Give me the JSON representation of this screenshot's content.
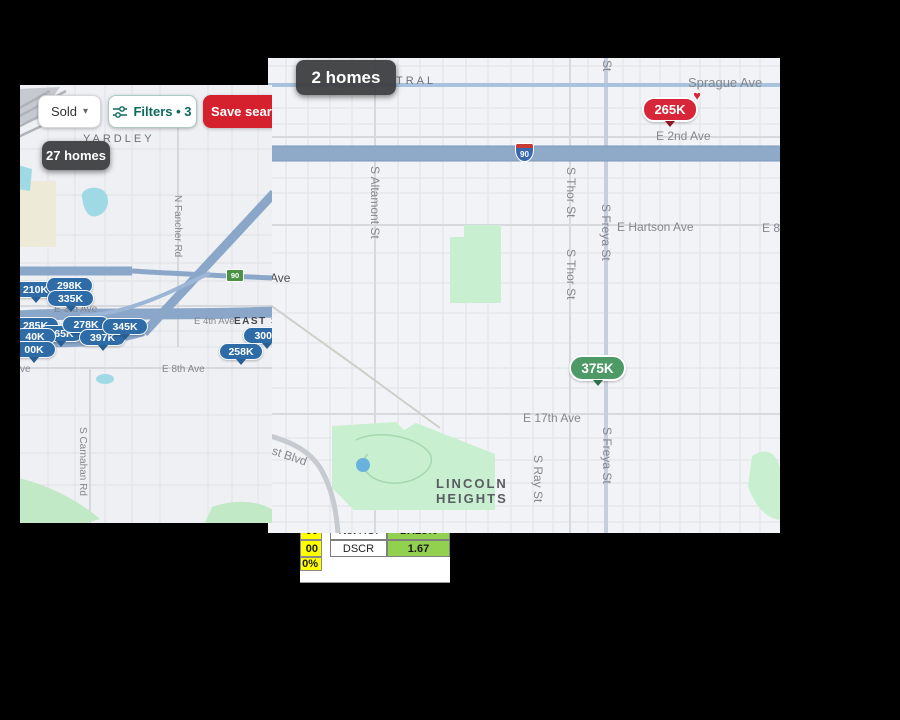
{
  "window_small_map": {
    "toolbar": {
      "sold": "Sold",
      "filters": "Filters • 3",
      "save_search": "Save search"
    },
    "badge": "27 homes",
    "shield": "90",
    "area_labels": {
      "yardley": "YARDLEY",
      "east_s": "EAST S"
    },
    "street_labels": {
      "e3rd": "E 3rd Ave",
      "e4th": "E 4th Ave",
      "e8th": "E 8th Ave",
      "ave_clipped": "ve",
      "fancher": "N Fancher Rd",
      "carnahan": "S Carnahan Rd"
    },
    "pins": [
      {
        "label": "210K"
      },
      {
        "label": "298K"
      },
      {
        "label": "335K"
      },
      {
        "label": "285K"
      },
      {
        "label": "165K"
      },
      {
        "label": "278K"
      },
      {
        "label": "397K"
      },
      {
        "label": "345K"
      },
      {
        "label": "40K"
      },
      {
        "label": "00K"
      },
      {
        "label": "300K"
      },
      {
        "label": "258K"
      }
    ]
  },
  "window_large_map": {
    "badge": "2 homes",
    "shield": "90",
    "area_labels": {
      "central_clipped": "TRAL",
      "lincoln_line1": "LINCOLN",
      "lincoln_line2": "HEIGHTS"
    },
    "street_labels": {
      "sprague": "Sprague Ave",
      "e2nd": "E 2nd Ave",
      "st_clipped": "St",
      "ave_clipped": "Ave",
      "hartson": "E Hartson Ave",
      "e8th_clipped": "E 8t",
      "e17th": "E 17th Ave",
      "blvd_clipped": "ast Blvd",
      "altamont": "S Altamont St",
      "thor_a": "S Thor St",
      "thor_b": "S Thor St",
      "freya_a": "S Freya St",
      "freya_b": "S Freya St",
      "ray": "S Ray St"
    },
    "pins": {
      "favorite": {
        "label": "265K"
      },
      "green": {
        "label": "375K"
      }
    }
  },
  "spreadsheet": {
    "rows": [
      {
        "input": "00",
        "label": "Net ROI",
        "value": "17.28%"
      },
      {
        "input": "00",
        "label": "DSCR",
        "value": "1.67"
      },
      {
        "input": "0%",
        "label": "",
        "value": ""
      }
    ]
  },
  "icons": {
    "chevron_down": "▾",
    "heart": "♥"
  },
  "colors": {
    "save_button_red": "#d4212d",
    "filters_teal": "#0c6b5d",
    "pin_blue": "#2e6ca8",
    "pin_red": "#d7263a",
    "pin_green": "#4d9a66",
    "badge_gray": "#3f4245",
    "cell_yellow": "#ffff00",
    "cell_green": "#92d050",
    "freeway_blue": "#8aa7c9",
    "water_cyan": "#9fd9e6",
    "park_green": "#c8efcf"
  }
}
